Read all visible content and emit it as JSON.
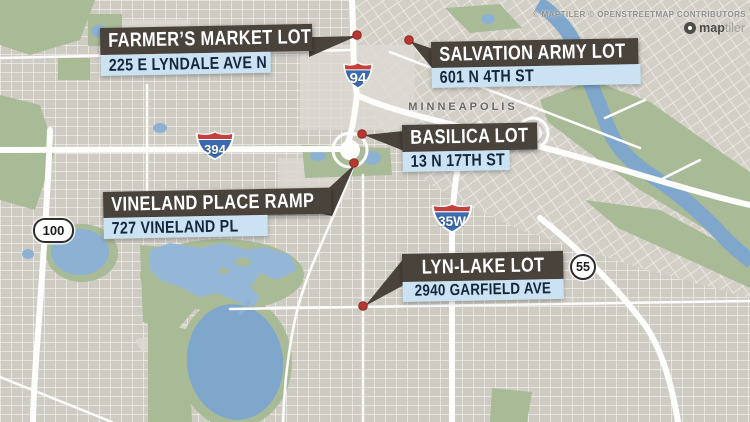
{
  "map": {
    "city_label": "MINNEAPOLIS",
    "attribution": "© MAPTILER © OPENSTREETMAP CONTRIBUTORS",
    "logo_bold": "map",
    "logo_light": "tiler"
  },
  "locations": [
    {
      "name": "FARMER’S MARKET LOT",
      "address": "225 E LYNDALE AVE N"
    },
    {
      "name": "SALVATION ARMY LOT",
      "address": "601 N 4TH ST"
    },
    {
      "name": "BASILICA LOT",
      "address": "13 N 17TH ST"
    },
    {
      "name": "VINELAND PLACE RAMP",
      "address": "727 VINELAND PL"
    },
    {
      "name": "LYN-LAKE LOT",
      "address": "2940 GARFIELD AVE"
    }
  ],
  "shields": [
    {
      "type": "interstate",
      "number": "94"
    },
    {
      "type": "interstate",
      "number": "394"
    },
    {
      "type": "interstate",
      "number": "35W"
    },
    {
      "type": "state",
      "number": "100"
    },
    {
      "type": "state",
      "number": "55"
    }
  ],
  "colors": {
    "label_box": "#4a433c",
    "label_address_bg": "#cbe2f2",
    "label_address_text": "#15273a",
    "marker_red": "#b63831",
    "water": "#7fa6cb",
    "park": "#a9ba97",
    "interstate_blue": "#3b6ab0",
    "interstate_red": "#c2413a"
  }
}
